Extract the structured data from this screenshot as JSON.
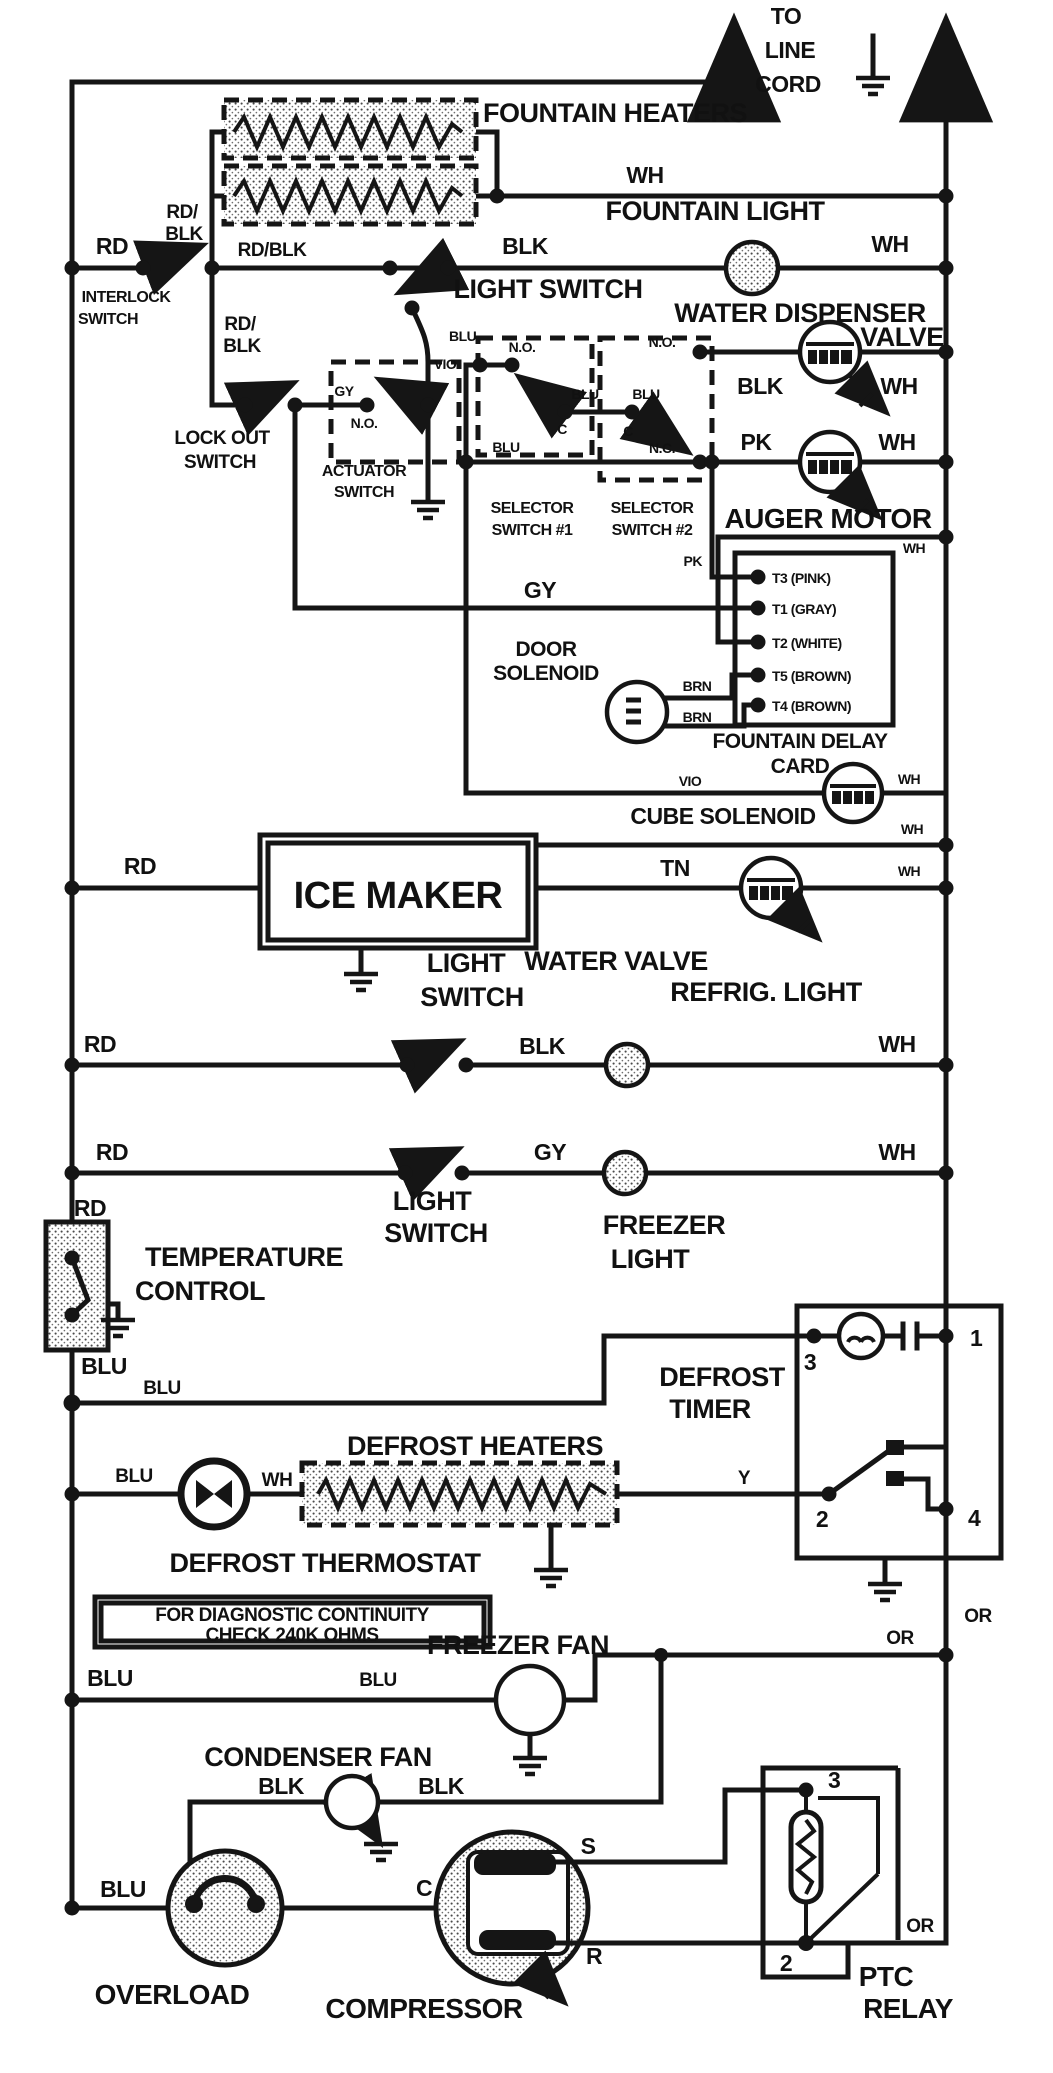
{
  "title": "Refrigerator wiring schematic",
  "power": {
    "to": "TO",
    "line": "LINE",
    "cord": "CORD"
  },
  "wires": {
    "wh": "WH",
    "blk": "BLK",
    "rd": "RD",
    "rd_blk": "RD/BLK",
    "rd_s": "RD/",
    "blk_s": "BLK",
    "blu": "BLU",
    "vio": "VIO",
    "gy": "GY",
    "pk": "PK",
    "tn": "TN",
    "brn": "BRN",
    "y": "Y",
    "or": "OR"
  },
  "contacts": {
    "no": "N.O.",
    "nc": "N.C.",
    "c": "C"
  },
  "components": {
    "fountain_heaters": "FOUNTAIN HEATERS",
    "fountain_light": "FOUNTAIN LIGHT",
    "light_switch": "LIGHT SWITCH",
    "light": "LIGHT",
    "switch": "SWITCH",
    "interlock": "INTERLOCK",
    "lock_out": "LOCK OUT",
    "actuator": "ACTUATOR",
    "selector": "SELECTOR",
    "switch1": "SWITCH #1",
    "switch2": "SWITCH #2",
    "water_dispenser": "WATER DISPENSER",
    "valve": "VALVE",
    "auger_motor": "AUGER MOTOR",
    "door": "DOOR",
    "solenoid": "SOLENOID",
    "fountain_delay": "FOUNTAIN DELAY",
    "card": "CARD",
    "cube_solenoid": "CUBE SOLENOID",
    "ice_maker": "ICE MAKER",
    "water_valve": "WATER VALVE",
    "refrig_light": "REFRIG. LIGHT",
    "freezer": "FREEZER",
    "temperature": "TEMPERATURE",
    "control": "CONTROL",
    "defrost": "DEFROST",
    "timer": "TIMER",
    "defrost_heaters": "DEFROST HEATERS",
    "defrost_thermostat": "DEFROST THERMOSTAT",
    "freezer_fan": "FREEZER FAN",
    "condenser_fan": "CONDENSER FAN",
    "overload": "OVERLOAD",
    "compressor": "COMPRESSOR",
    "ptc": "PTC",
    "relay": "RELAY"
  },
  "card_terminals": [
    "T3 (PINK)",
    "T1 (GRAY)",
    "T2 (WHITE)",
    "T5 (BROWN)",
    "T4 (BROWN)"
  ],
  "timer_pins": {
    "p1": "1",
    "p2": "2",
    "p3": "3",
    "p4": "4"
  },
  "ptc_pins": {
    "p2": "2",
    "p3": "3"
  },
  "compressor_pins": {
    "s": "S",
    "c": "C",
    "r": "R"
  },
  "note": [
    "FOR DIAGNOSTIC CONTINUITY",
    "CHECK 240K OHMS"
  ]
}
